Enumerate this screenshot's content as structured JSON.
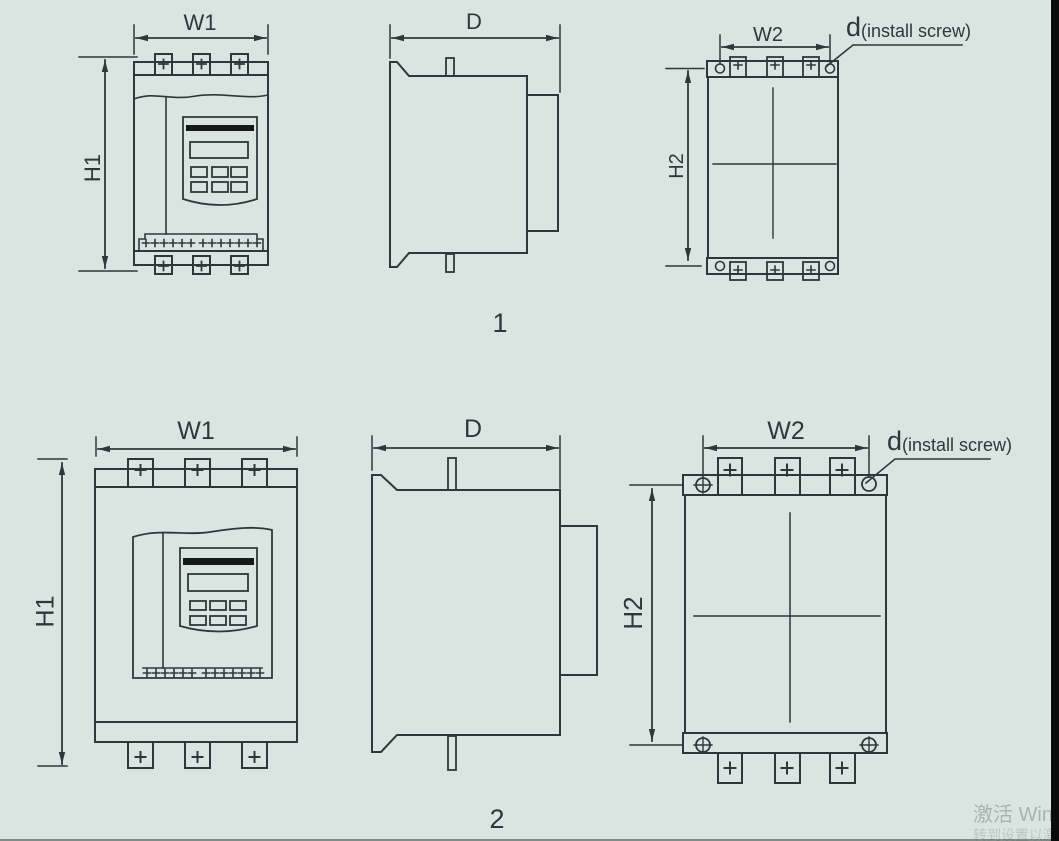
{
  "page": {
    "background_color": "#dae5e1",
    "line_color": "#2e383c",
    "description": "Soft starter outline and mounting dimension drawings, two size variants"
  },
  "figure1": {
    "number": "1",
    "front": {
      "width_label": "W1",
      "height_label": "H1"
    },
    "side": {
      "depth_label": "D"
    },
    "back": {
      "width_label": "W2",
      "height_label": "H2",
      "screw_dim": "d",
      "screw_note": "(install screw)"
    }
  },
  "figure2": {
    "number": "2",
    "front": {
      "width_label": "W1",
      "height_label": "H1"
    },
    "side": {
      "depth_label": "D"
    },
    "back": {
      "width_label": "W2",
      "height_label": "H2",
      "screw_dim": "d",
      "screw_note": "(install screw)"
    }
  },
  "watermark": {
    "line1": "激活 Win",
    "line2": "转到设置以激活 Windows"
  }
}
